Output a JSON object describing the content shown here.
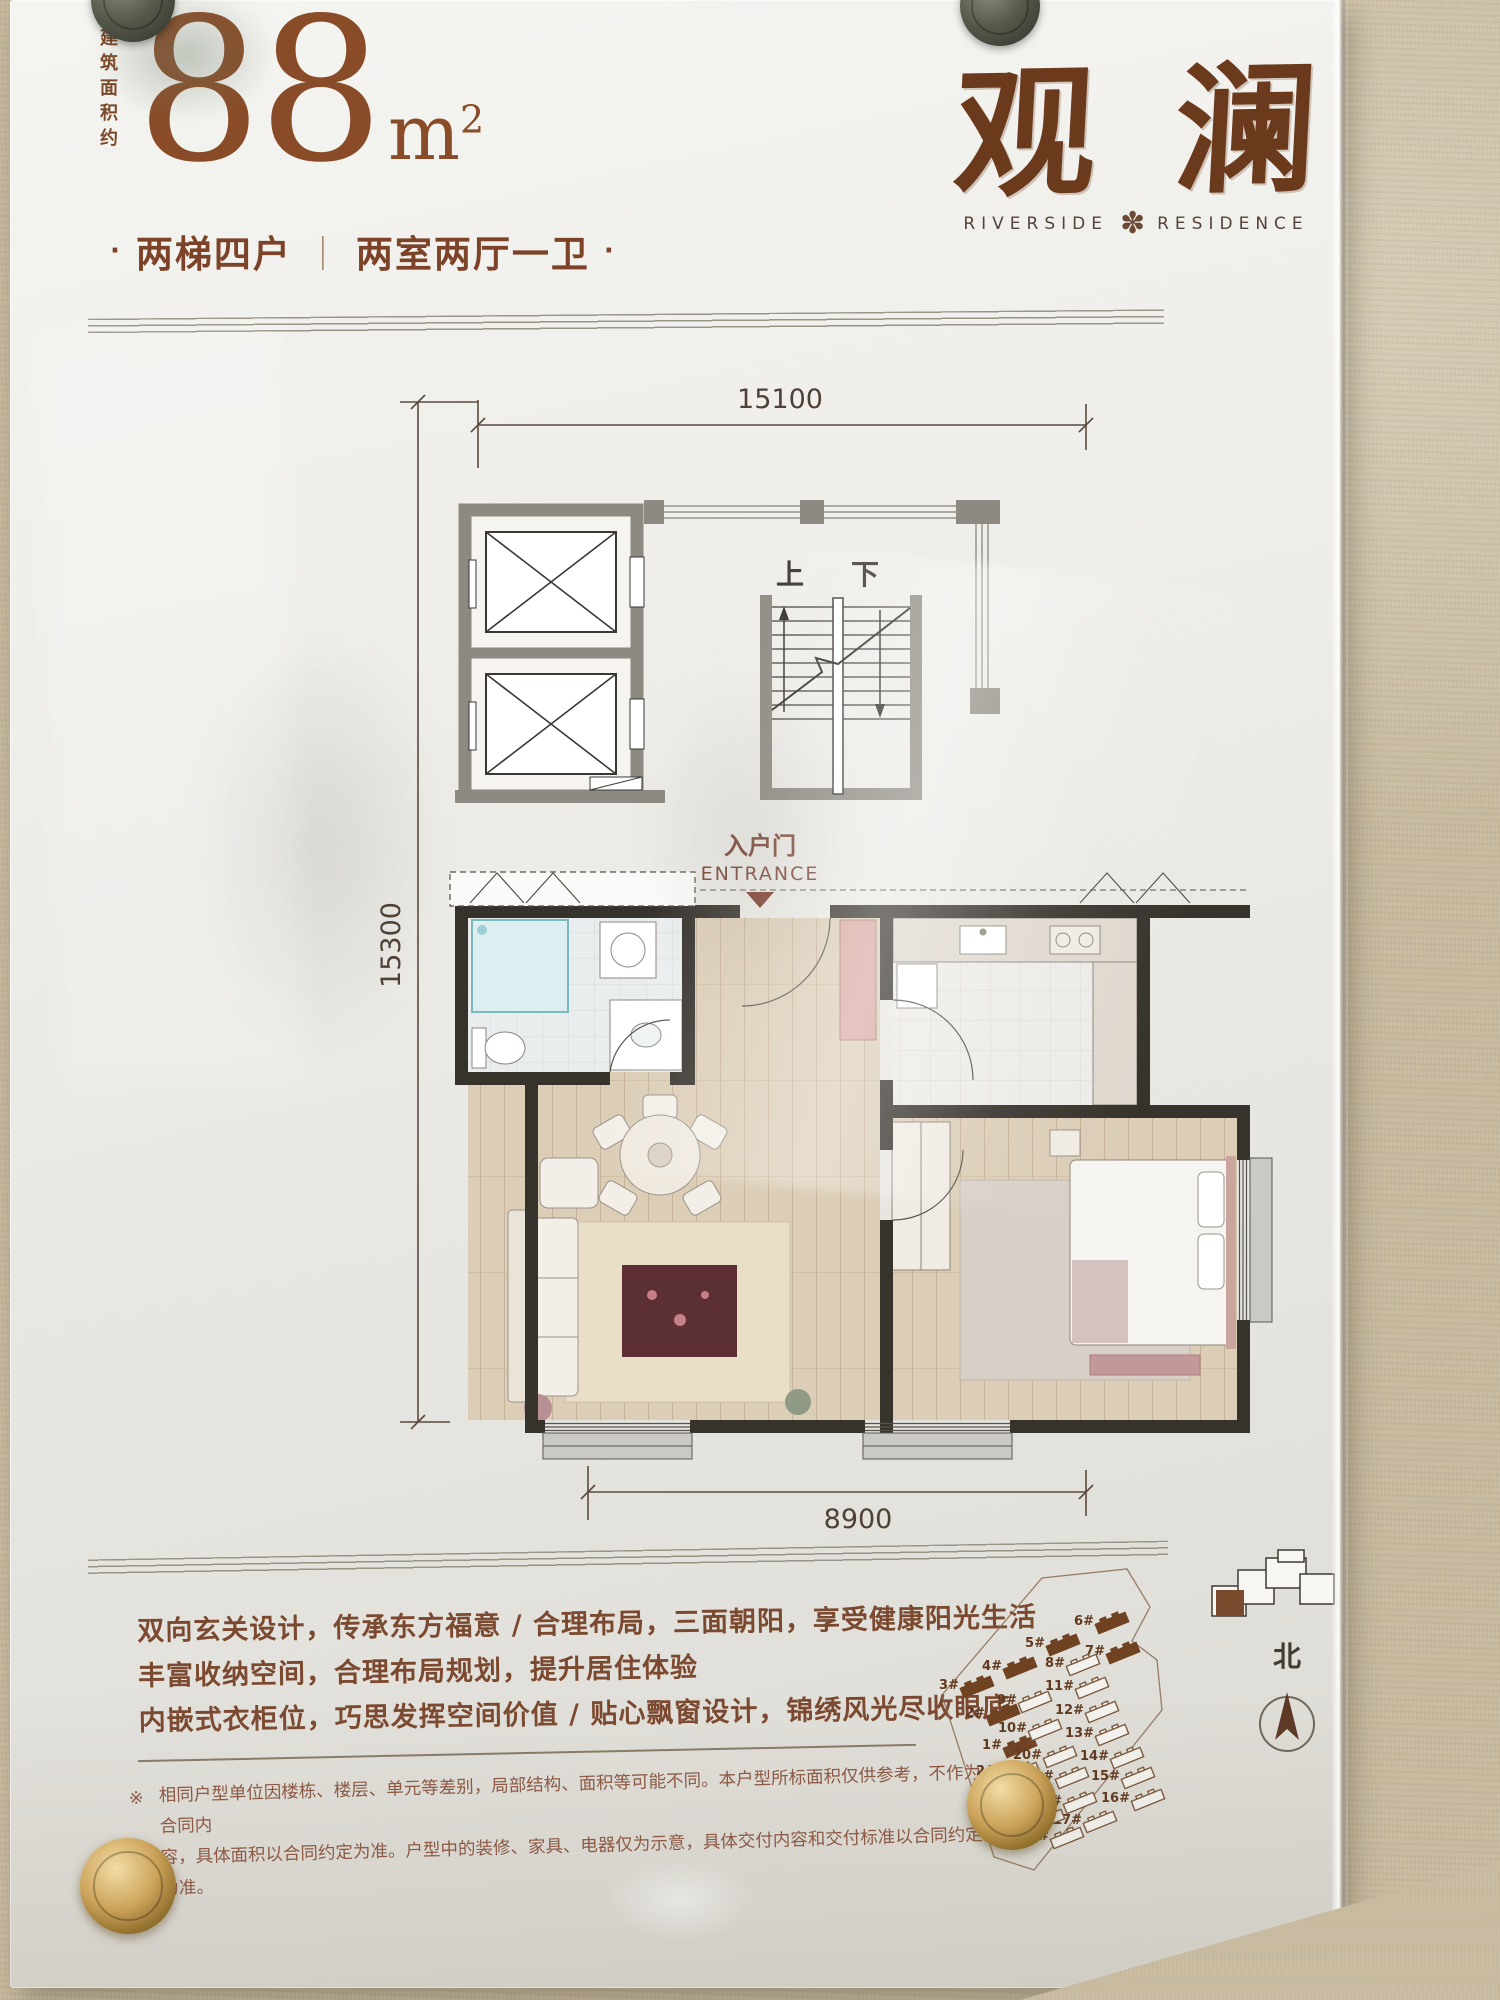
{
  "colors": {
    "brand_brown": "#6b3a1d",
    "area_brown": "#8a4c28",
    "text_brown": "#7b4930",
    "wall_dark": "#36322c",
    "wall_gray": "#8e8a81",
    "wall_beige": "#c6b99e",
    "entrance_red": "#7c392d"
  },
  "poster": {
    "header": {
      "area_prefix": "建筑面积约",
      "area_value": "88",
      "area_unit_base": "m",
      "area_unit_sup": "2",
      "subtitle": {
        "bullet": "·",
        "left": "两梯四户",
        "divider": "｜",
        "right": "两室两厅一卫"
      }
    },
    "brand": {
      "logo_char1": "观",
      "logo_char2": "澜",
      "tagline_left": "RIVERSIDE",
      "medallion": "✽",
      "tagline_right": "RESIDENCE"
    },
    "floorplan": {
      "dim_top": "15100",
      "dim_left": "15300",
      "dim_bottom": "8900",
      "stair_up": "上",
      "stair_down": "下",
      "entrance_cn": "入户门",
      "entrance_en": "ENTRANCE"
    },
    "features": [
      "双向玄关设计，传承东方福意 / 合理布局，三面朝阳，享受健康阳光生活",
      "丰富收纳空间，合理布局规划，提升居住体验",
      "内嵌式衣柜位，巧思发挥空间价值 / 贴心飘窗设计，锦绣风光尽收眼底"
    ],
    "disclaimer": {
      "marker": "※",
      "line1": "相同户型单位因楼栋、楼层、单元等差别，局部结构、面积等可能不同。本户型所标面积仅供参考，不作为合同内",
      "line2": "容，具体面积以合同约定为准。户型中的装修、家具、电器仅为示意，具体交付内容和交付标准以合同约定为准。"
    },
    "siteplan": {
      "north_label": "北",
      "buildings": [
        {
          "label": "1#",
          "x": 98,
          "y": 202,
          "filled": true
        },
        {
          "label": "2#",
          "x": 81,
          "y": 170,
          "filled": true
        },
        {
          "label": "3#",
          "x": 55,
          "y": 142,
          "filled": true
        },
        {
          "label": "4#",
          "x": 98,
          "y": 123,
          "filled": true
        },
        {
          "label": "5#",
          "x": 141,
          "y": 100,
          "filled": true
        },
        {
          "label": "6#",
          "x": 190,
          "y": 78,
          "filled": true
        },
        {
          "label": "7#",
          "x": 201,
          "y": 108,
          "filled": true
        },
        {
          "label": "8#",
          "x": 161,
          "y": 120,
          "filled": false
        },
        {
          "label": "9#",
          "x": 113,
          "y": 157,
          "filled": false
        },
        {
          "label": "10#",
          "x": 123,
          "y": 185,
          "filled": false
        },
        {
          "label": "11#",
          "x": 170,
          "y": 143,
          "filled": false
        },
        {
          "label": "12#",
          "x": 180,
          "y": 167,
          "filled": false
        },
        {
          "label": "13#",
          "x": 190,
          "y": 190,
          "filled": false
        },
        {
          "label": "14#",
          "x": 205,
          "y": 213,
          "filled": false
        },
        {
          "label": "15#",
          "x": 216,
          "y": 233,
          "filled": false
        },
        {
          "label": "16#",
          "x": 226,
          "y": 255,
          "filled": false
        },
        {
          "label": "17#",
          "x": 178,
          "y": 277,
          "filled": false
        },
        {
          "label": "18#",
          "x": 158,
          "y": 258,
          "filled": false
        },
        {
          "label": "19#",
          "x": 150,
          "y": 233,
          "filled": false
        },
        {
          "label": "20#",
          "x": 138,
          "y": 212,
          "filled": false
        },
        {
          "label": "21#",
          "x": 145,
          "y": 293,
          "filled": false
        },
        {
          "label": "22#",
          "x": 126,
          "y": 275,
          "filled": false
        },
        {
          "label": "23#",
          "x": 116,
          "y": 252,
          "filled": false
        },
        {
          "label": "24#",
          "x": 101,
          "y": 228,
          "filled": false
        }
      ]
    }
  }
}
